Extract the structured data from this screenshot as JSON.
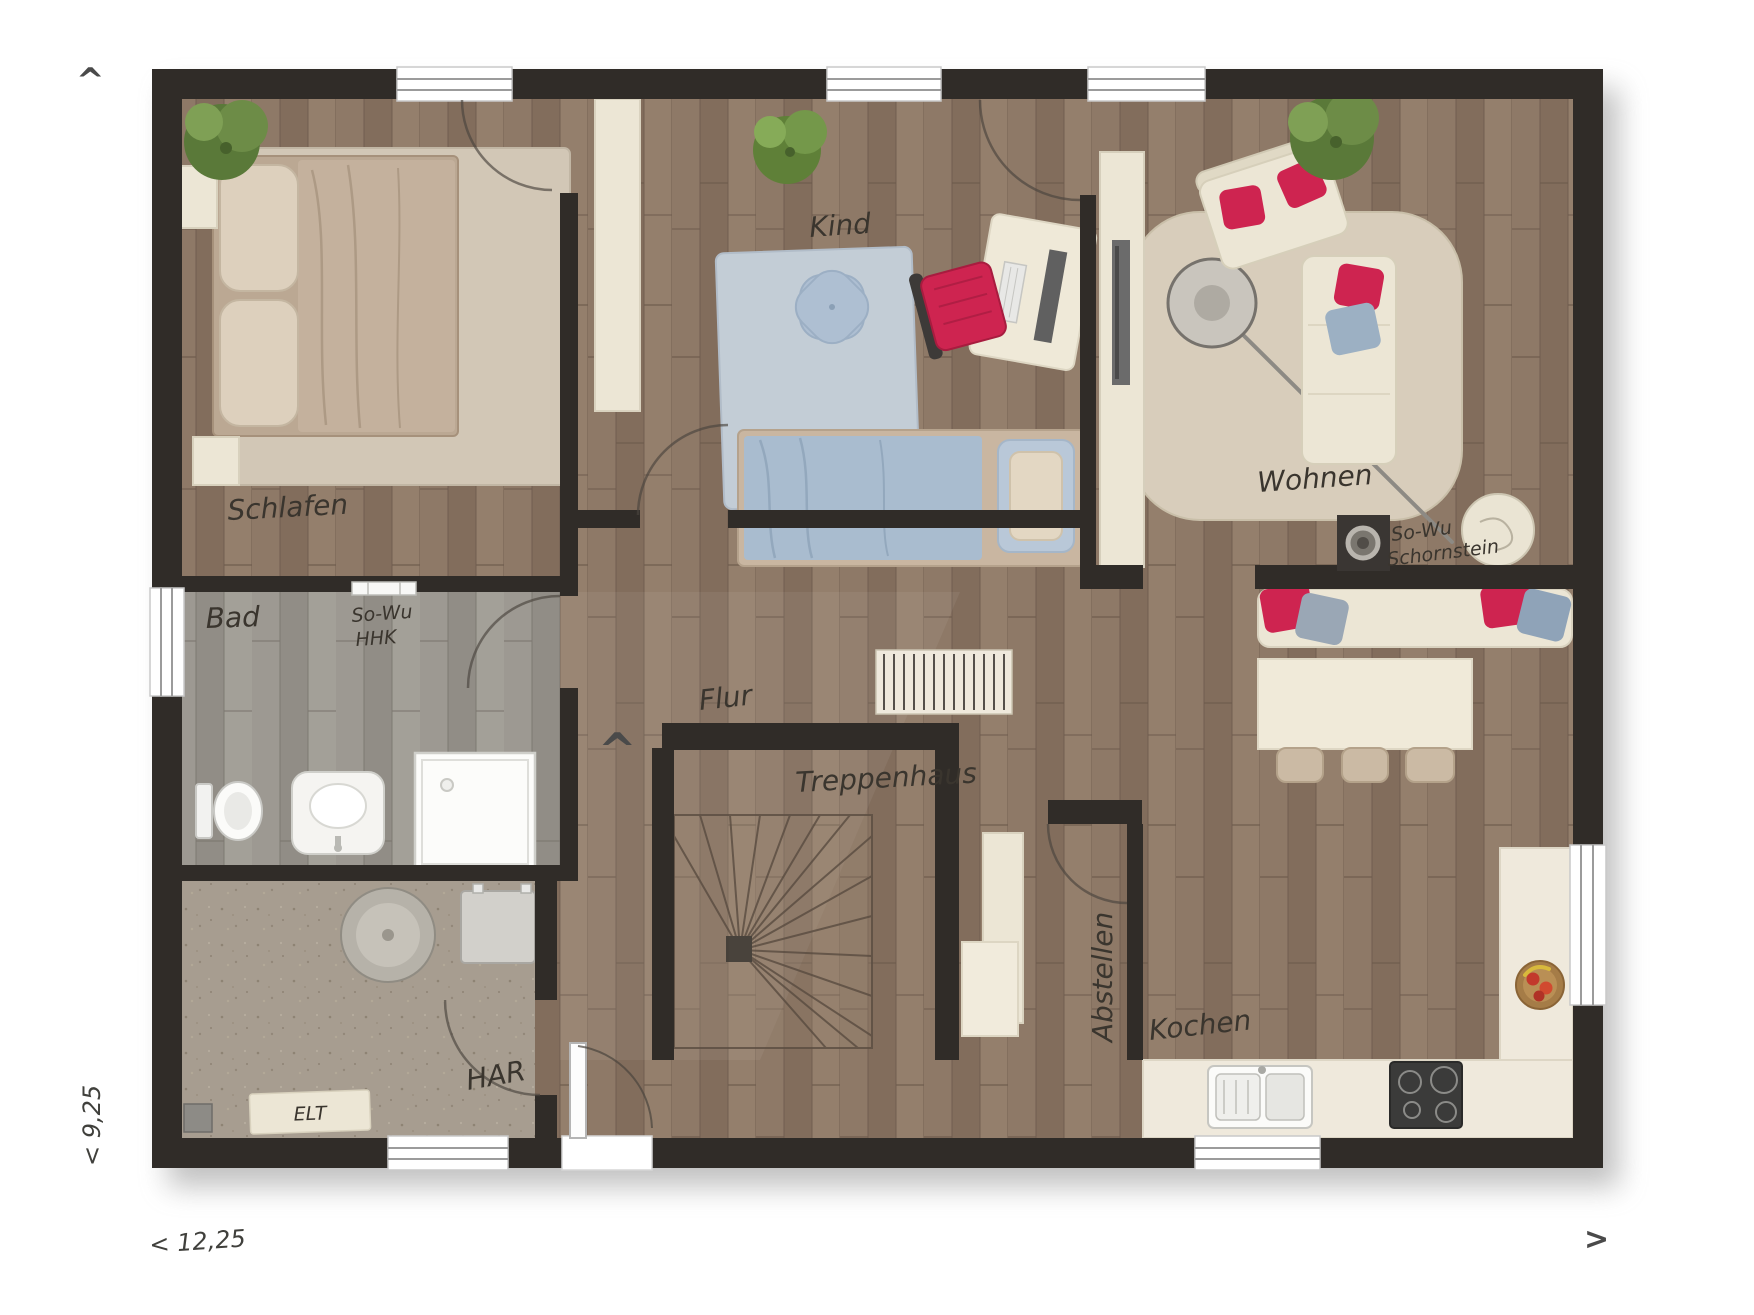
{
  "rooms": {
    "schlafen": "Schlafen",
    "kind": "Kind",
    "wohnen": "Wohnen",
    "bad": "Bad",
    "flur": "Flur",
    "treppenhaus": "Treppenhaus",
    "har": "HAR",
    "abstellen": "Abstellen",
    "kochen": "Kochen"
  },
  "annotations": {
    "elt": "ELT",
    "so_wu_bad_line1": "So-Wu",
    "so_wu_bad_line2": "HHK",
    "so_wu_wohnen_line1": "So-Wu",
    "so_wu_wohnen_line2": "Schornstein"
  },
  "dimensions": {
    "width": "< 12,25",
    "depth": "< 9,25"
  },
  "markers": {
    "north_arrow": "^",
    "east_arrow": ">",
    "stair_arrow": "^"
  },
  "colors": {
    "wall": "#302c28",
    "accent_red": "#ce2450",
    "floor_wood": "#8b7664",
    "floor_bad": "#9b978f",
    "floor_har": "#a79d90",
    "furniture_cream": "#ece6d5",
    "rug_wohnen": "#d8cdbb",
    "rug_kind": "#c3cdd6",
    "rug_schlafen": "#d2c7b6",
    "duvet_blue": "#a9bccf",
    "duvet_tan": "#c4b19d",
    "bench_gray": "#9aa7b5"
  }
}
